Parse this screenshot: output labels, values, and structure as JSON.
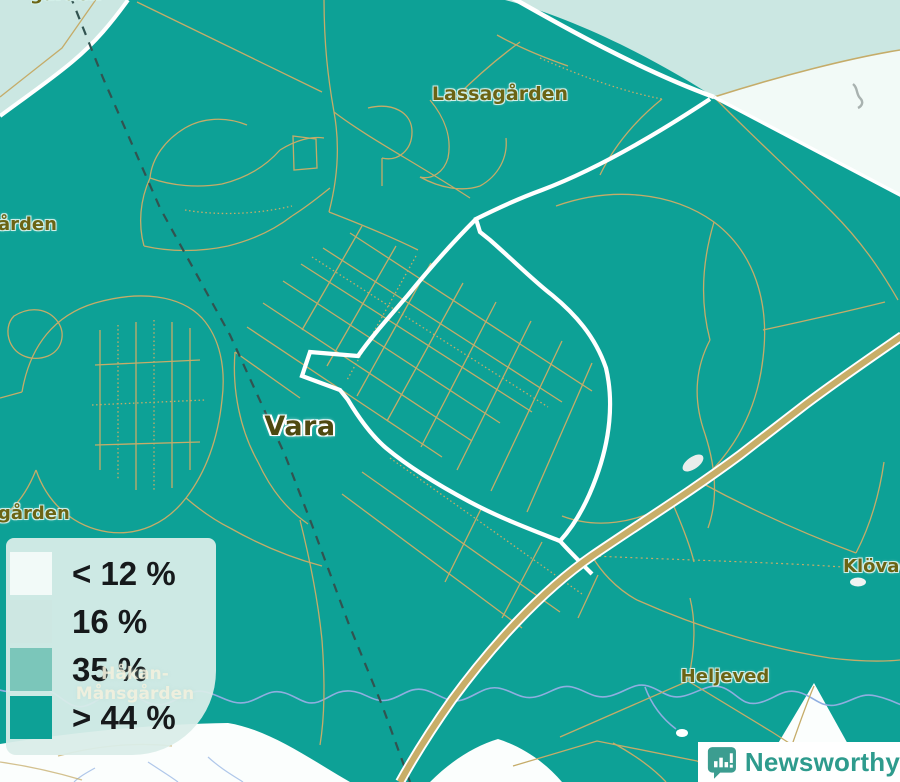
{
  "places": {
    "lassagarden": {
      "name": "Lassagården"
    },
    "vara": {
      "name": "Vara"
    },
    "heljeved": {
      "name": "Heljeved"
    },
    "klovagarden_partial": {
      "name": "Klövagår"
    },
    "west_edge_partial_upper": {
      "name": "ården"
    },
    "west_edge_partial_lower": {
      "name": "gården"
    },
    "top_edge_partial": {
      "name": "gården"
    },
    "hakan_mansgarden": {
      "line1": "Håkan-",
      "line2": "Månsgården"
    }
  },
  "legend": {
    "items": [
      {
        "label": "< 12 %",
        "color": "#F2FAF8"
      },
      {
        "label": "16 %",
        "color": "#CDE7E2"
      },
      {
        "label": "35 %",
        "color": "#7BC6BA"
      },
      {
        "label": "> 44 %",
        "color": "#0DA196"
      }
    ]
  },
  "watermark": {
    "brand": "Newsworthy"
  },
  "colors": {
    "map_background": "#0DA196",
    "area_light": "#CBE7E2",
    "area_lightest": "#F2FAF7",
    "area_white": "#FBFEFD",
    "road_minor": "#C5AC69",
    "road_major": "#C8AE68",
    "road_white": "#FFFFFF",
    "railway": "#315350",
    "water": "#8FAEE0",
    "place_label": "#6B6414",
    "legend_panel": "#DAEDE9",
    "brand_teal": "#2E9B8D"
  }
}
